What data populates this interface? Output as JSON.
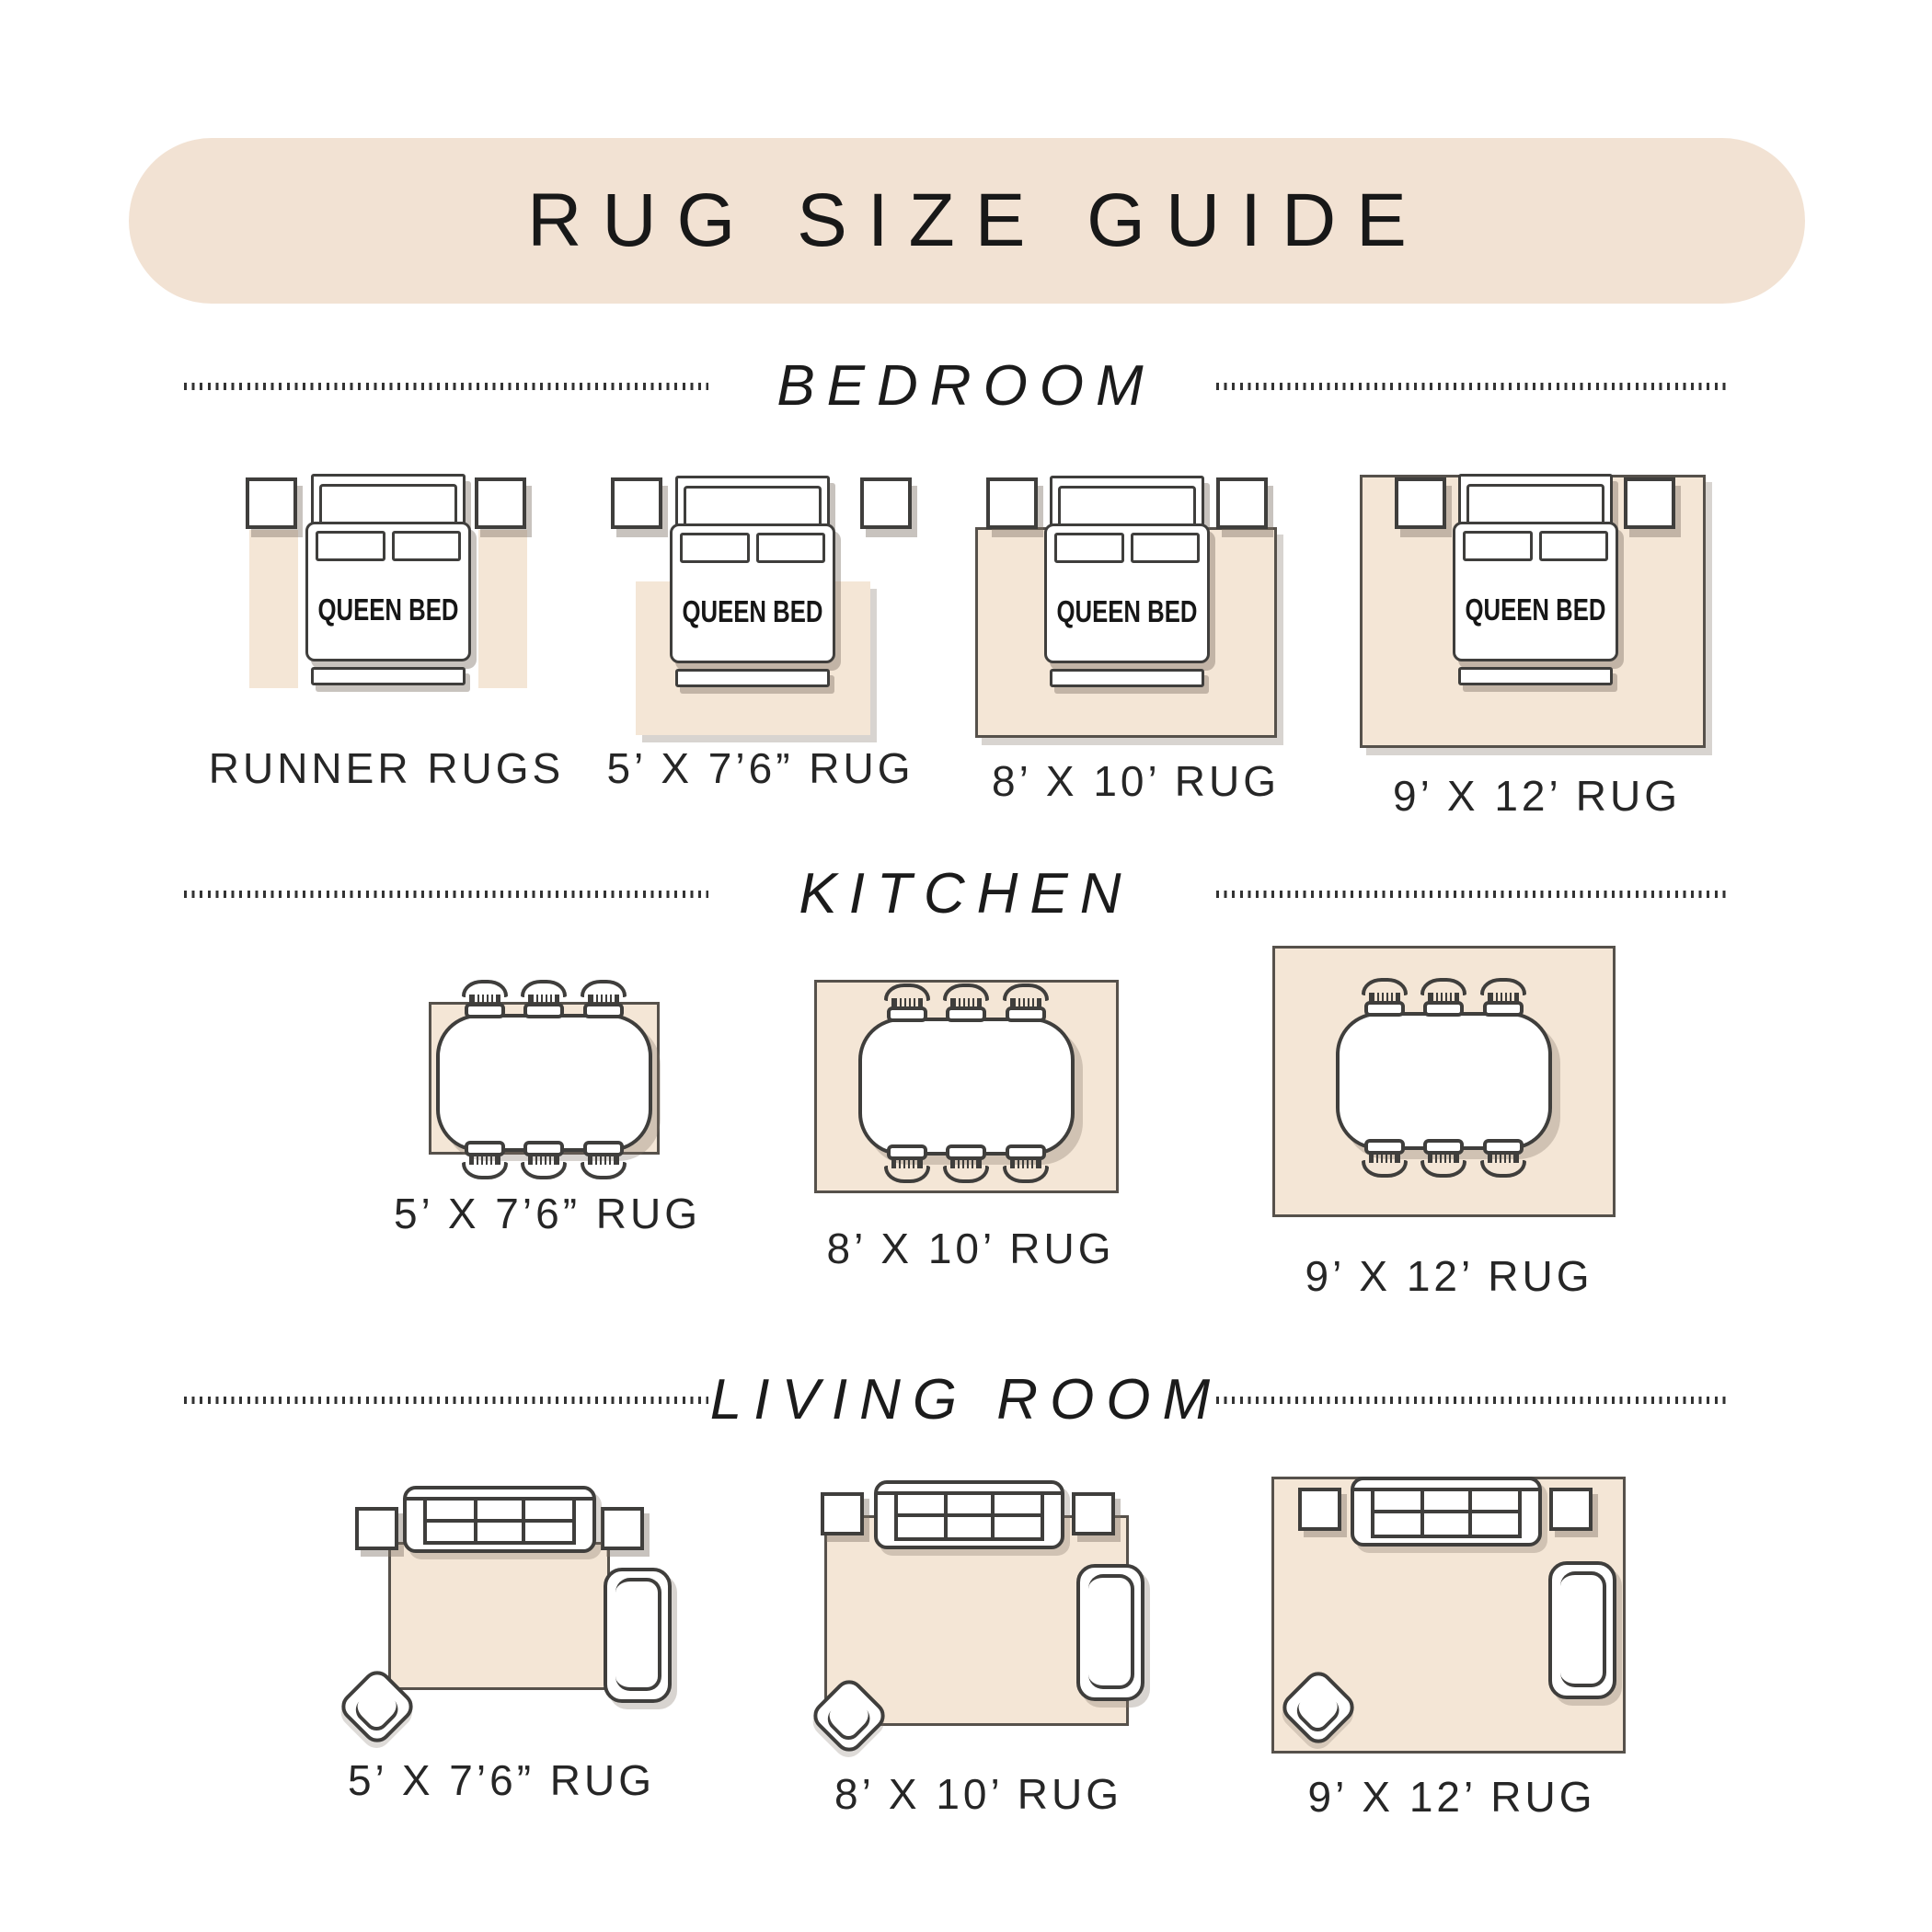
{
  "title": "RUG SIZE GUIDE",
  "bed_label": "QUEEN BED",
  "sections": [
    {
      "id": "bedroom",
      "heading": "BEDROOM",
      "items": [
        {
          "label": "RUNNER RUGS"
        },
        {
          "label": "5’ X 7’6” RUG"
        },
        {
          "label": "8’ X 10’ RUG"
        },
        {
          "label": "9’ X 12’ RUG"
        }
      ]
    },
    {
      "id": "kitchen",
      "heading": "KITCHEN",
      "items": [
        {
          "label": "5’ X 7’6” RUG"
        },
        {
          "label": "8’ X 10’ RUG"
        },
        {
          "label": "9’ X 12’ RUG"
        }
      ]
    },
    {
      "id": "living_room",
      "heading": "LIVING ROOM",
      "items": [
        {
          "label": "5’ X 7’6” RUG"
        },
        {
          "label": "8’ X 10’ RUG"
        },
        {
          "label": "9’ X 12’ RUG"
        }
      ]
    }
  ],
  "colors": {
    "banner_beige": "#f2e2d3",
    "rug_beige": "#f4e6d6",
    "outline": "#3f3e3c",
    "text": "#1d1d1d"
  }
}
